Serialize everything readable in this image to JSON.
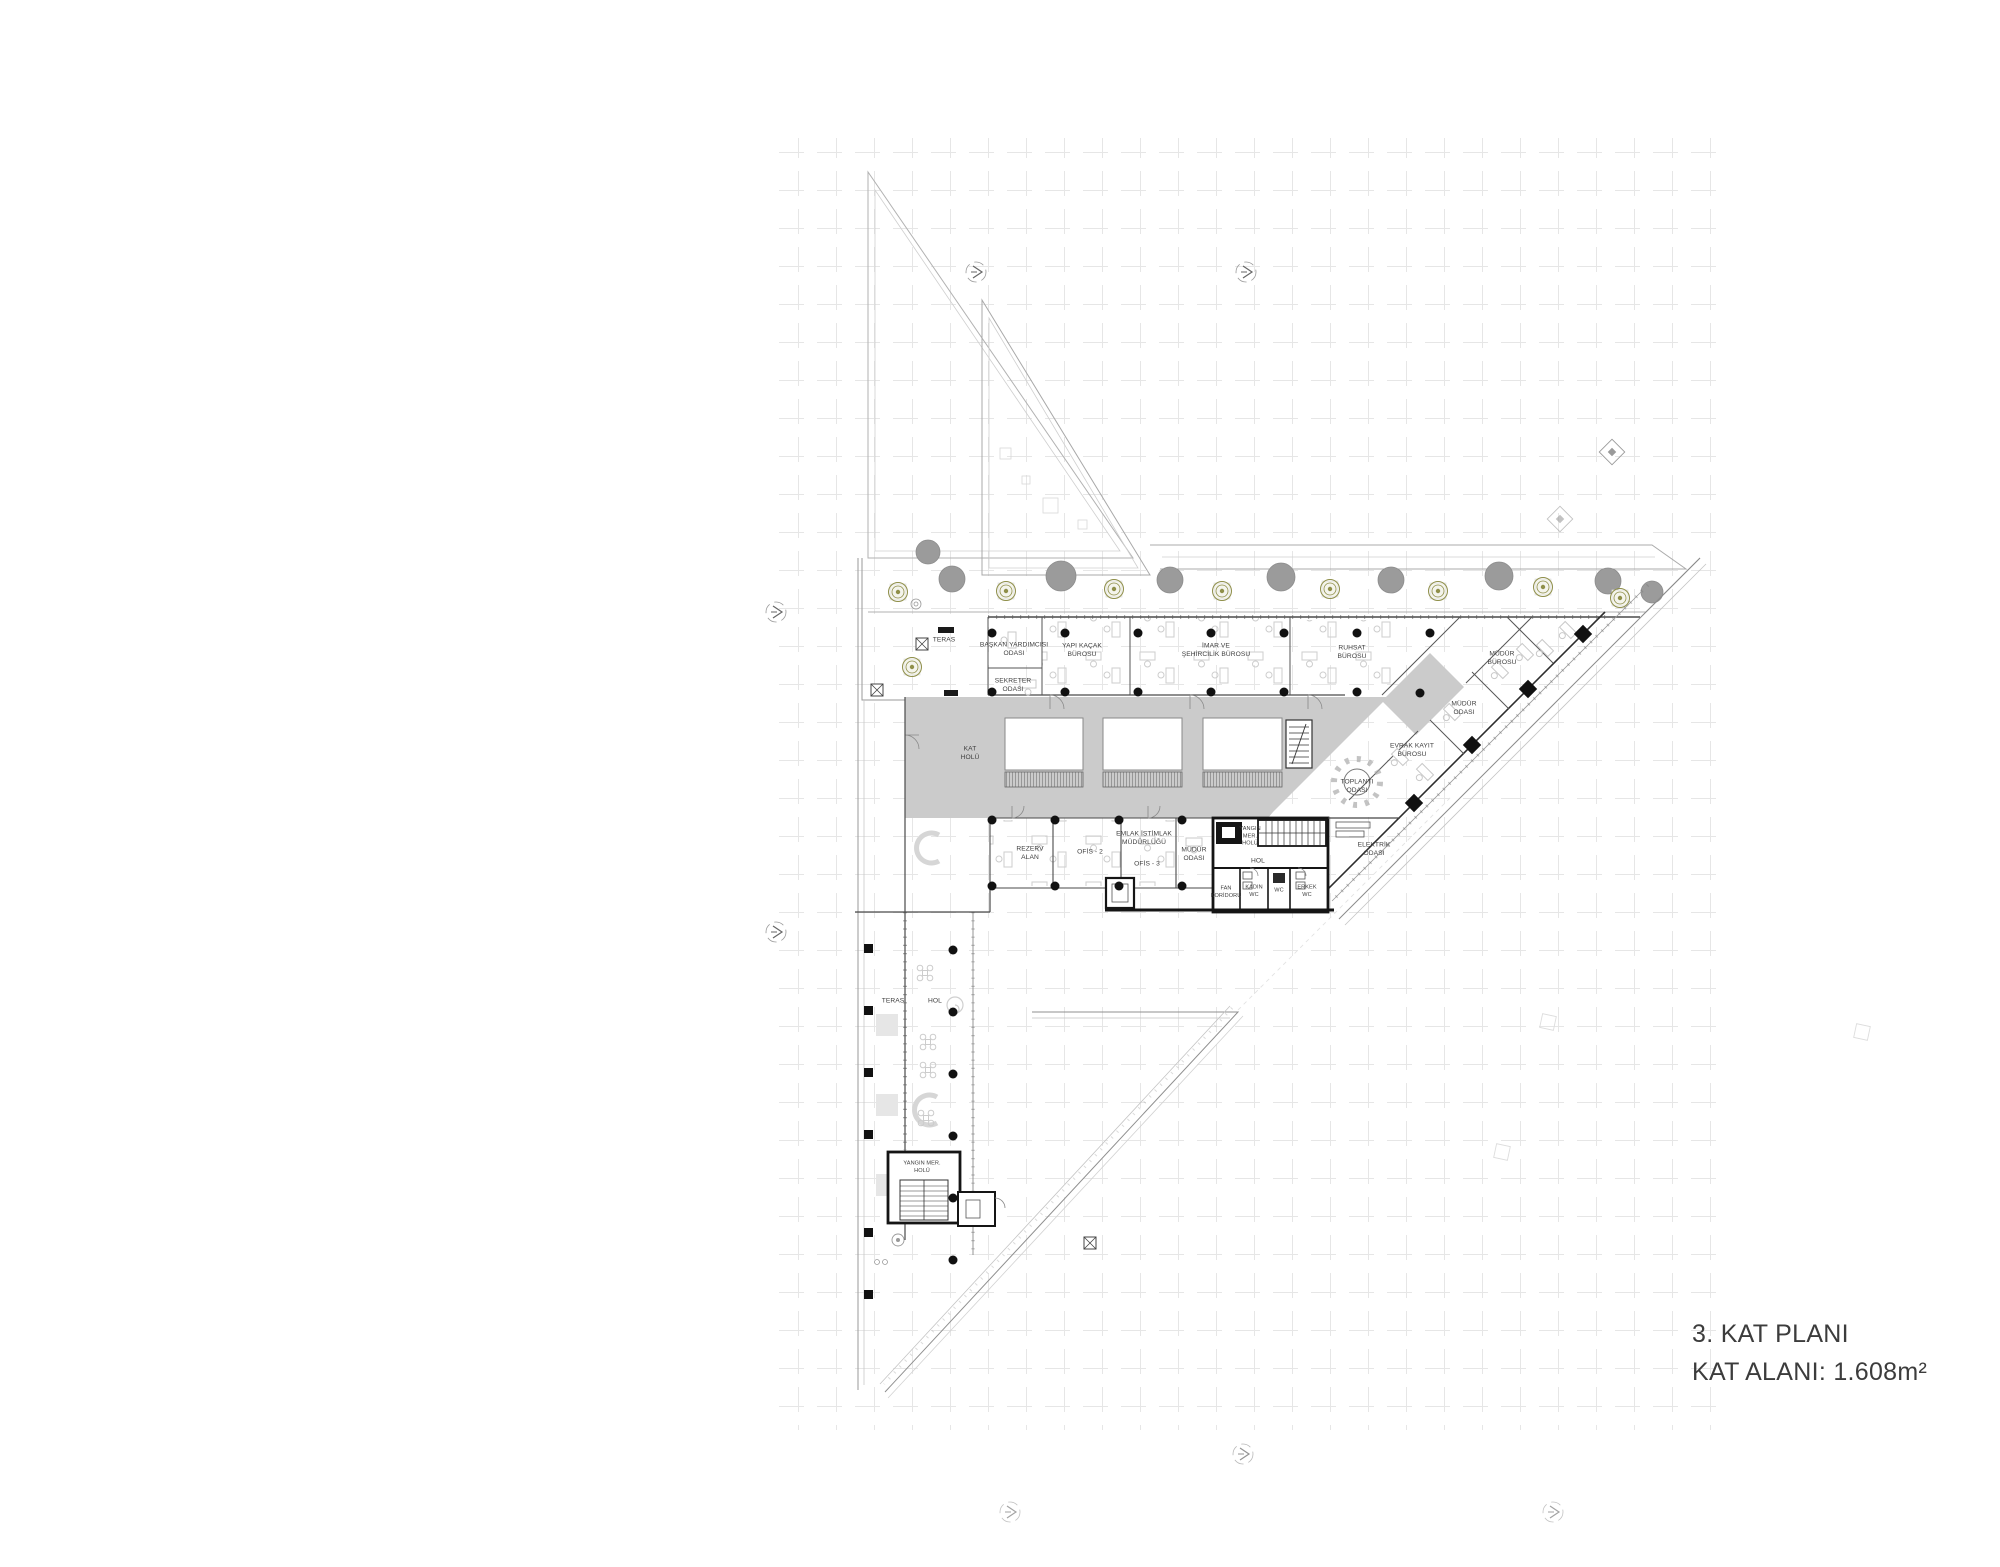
{
  "title": {
    "line1": "3. KAT PLANI",
    "line2": "KAT ALANI: 1.608m²"
  },
  "colors": {
    "corridor_gray": "#cbcbcb",
    "wall_black": "#151515",
    "wall_dark": "#454545",
    "line_light": "#b8b8b8",
    "grid_line": "#e2e2e2",
    "tree_olive": "#8f8f49",
    "tree_gray": "#9b9b9b",
    "label_text": "#3e3e3e"
  },
  "labels": {
    "teras_ust": "TERAS",
    "baskan": "BAŞKAN YARDIMCISI\nODASI",
    "sekreter": "SEKRETER\nODASI",
    "yapi_kacak": "YAPI KAÇAK\nBÜROSU",
    "imar": "İMAR VE\nŞEHİRCİLİK BÜROSU",
    "ruhsat": "RUHSAT\nBÜROSU",
    "mudur_burosu": "MÜDÜR\nBÜROSU",
    "mudur_odasi_sag": "MÜDÜR\nODASI",
    "evrak": "EVRAK KAYIT\nBÜROSU",
    "toplanti": "TOPLANTI\nODASI",
    "kat_holu": "KAT\nHOLÜ",
    "rezerv": "REZERV\nALAN",
    "ofis2": "OFİS - 2",
    "emlak": "EMLAK İSTİMLAK\nMÜDÜRLÜĞÜ",
    "ofis3": "OFİS - 3",
    "mudur_odasi_alt": "MÜDÜR\nODASI",
    "yangin_ust": "YANGIN\nMER.\nHOLÜ",
    "hol_core": "HOL",
    "fan_koridoru": "FAN\nKORİDORU",
    "kadin_wc": "KADIN\nWC",
    "eng_wc": "WC",
    "erkek_wc": "ERKEK\nWC",
    "elektrik": "ELEKTRİK\nODASI",
    "teras_alt": "TERAS",
    "hol_alt": "HOL",
    "yangin_alt": "YANGIN MER.\nHOLÜ"
  }
}
